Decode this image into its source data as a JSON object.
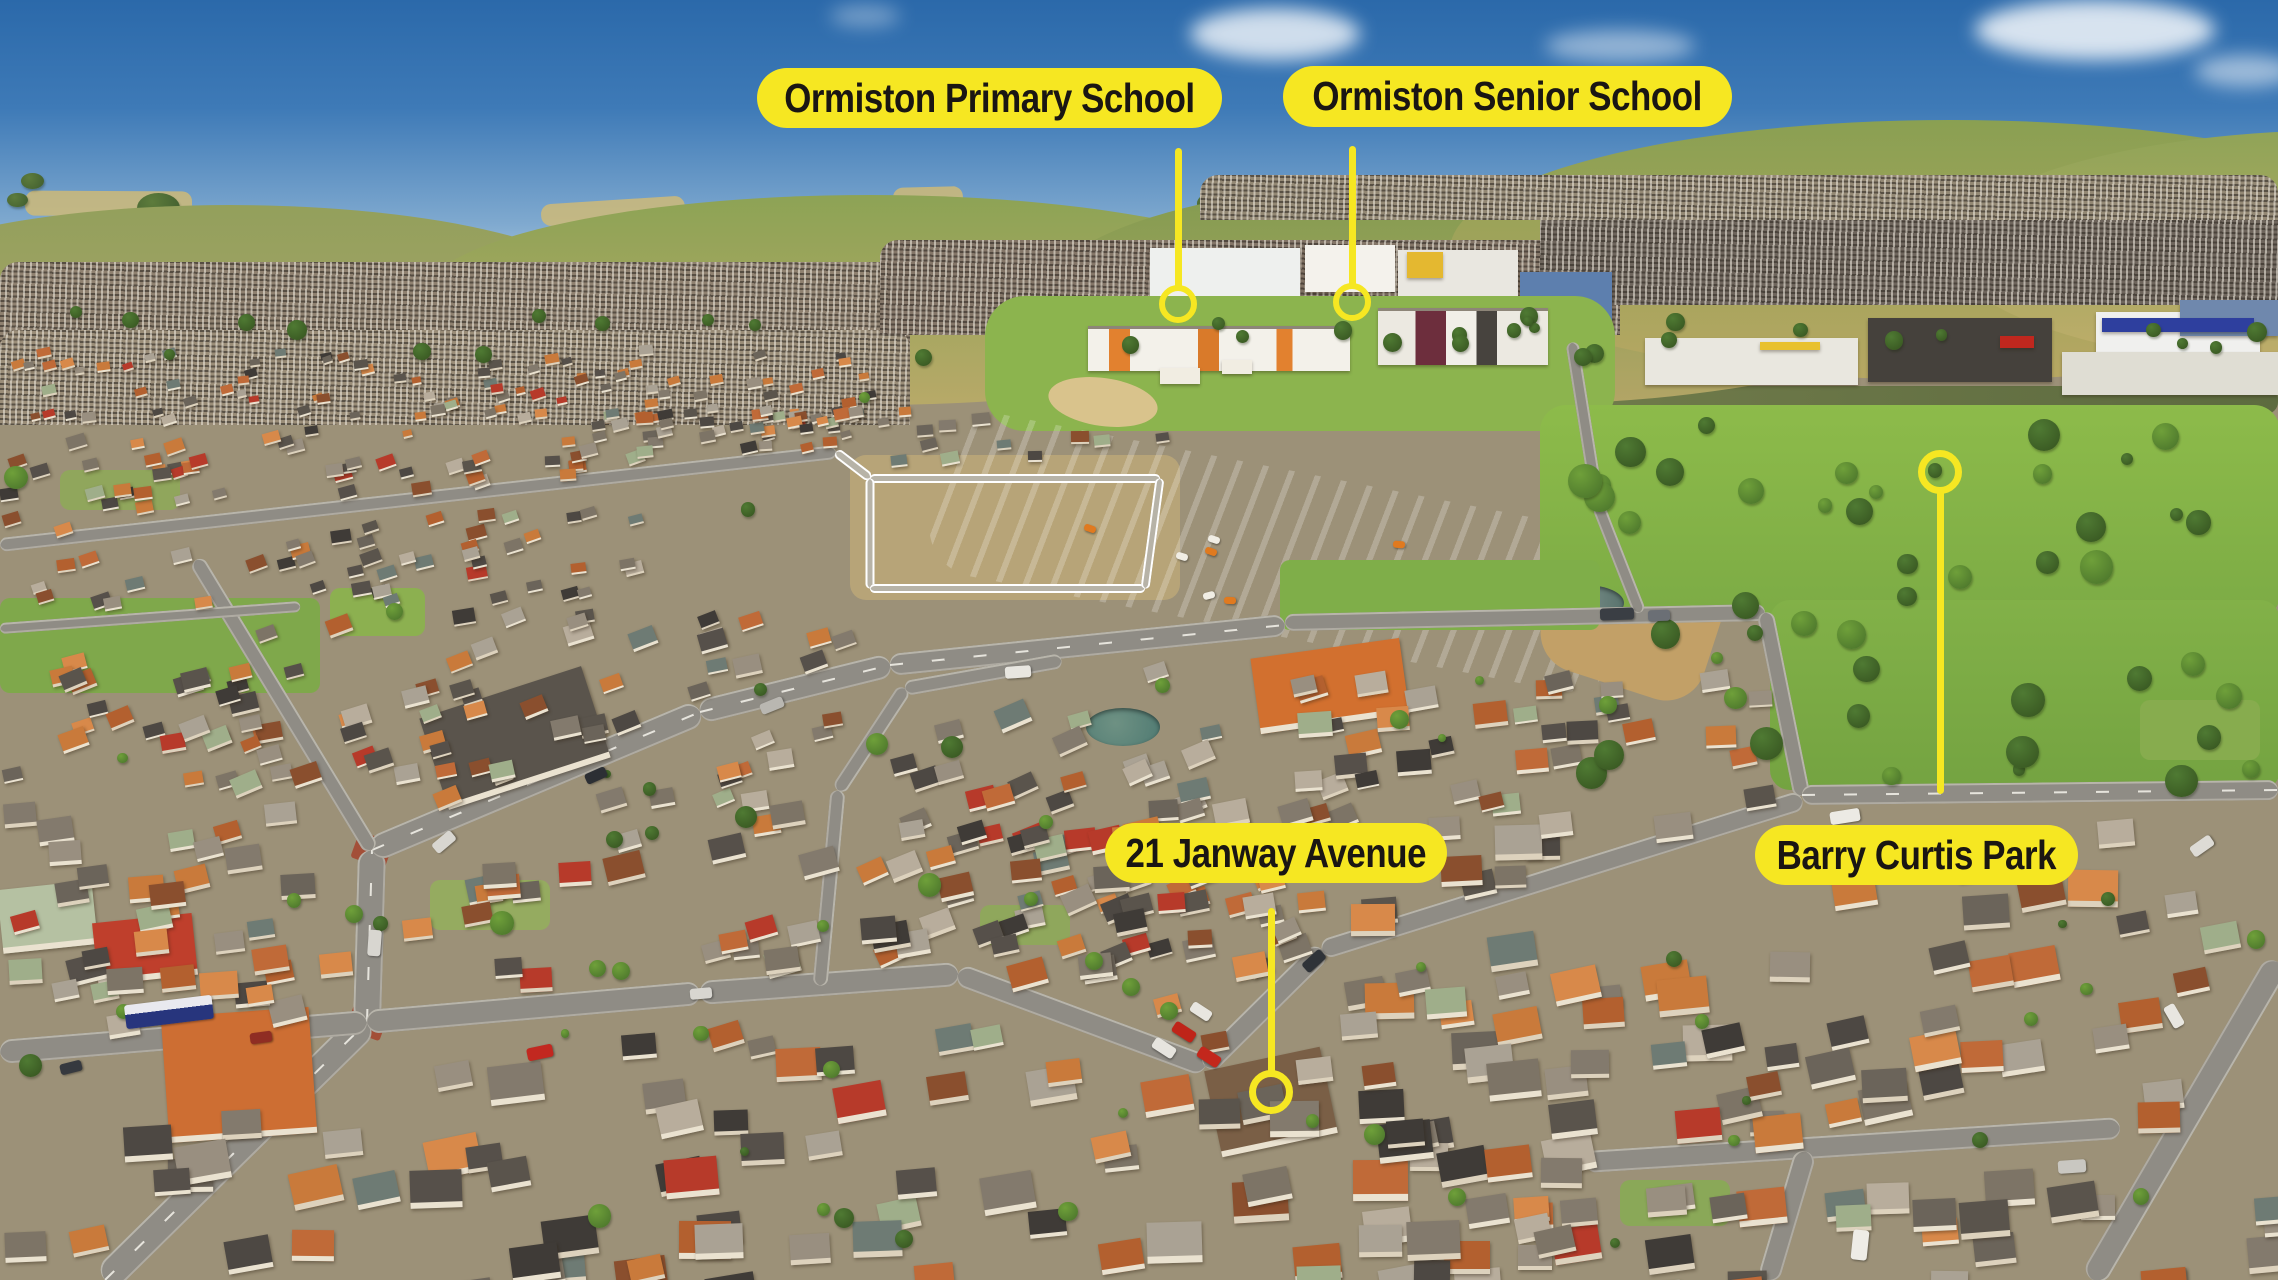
{
  "image_type": "aerial-photo-with-callouts",
  "colors": {
    "callout_fill": "#F6E722",
    "callout_text": "#1A1613"
  },
  "annotations": {
    "items": [
      {
        "id": "ormiston-primary-school",
        "label": "Ormiston Primary School",
        "pill": {
          "x": 757,
          "y": 68,
          "w": 465,
          "h": 60
        },
        "line": {
          "x": 1178,
          "y1": 148,
          "y2": 291
        },
        "ring": {
          "cx": 1178,
          "cy": 304,
          "r": 13,
          "stroke": 6
        }
      },
      {
        "id": "ormiston-senior-school",
        "label": "Ormiston Senior School",
        "pill": {
          "x": 1283,
          "y": 66,
          "w": 449,
          "h": 61
        },
        "line": {
          "x": 1352,
          "y1": 146,
          "y2": 289
        },
        "ring": {
          "cx": 1352,
          "cy": 302,
          "r": 13,
          "stroke": 6
        }
      },
      {
        "id": "21-janway-avenue",
        "label": "21 Janway Avenue",
        "pill": {
          "x": 1105,
          "y": 823,
          "w": 342,
          "h": 60
        },
        "line": {
          "x": 1271,
          "y1": 908,
          "y2": 1076
        },
        "ring": {
          "cx": 1271,
          "cy": 1092,
          "r": 15,
          "stroke": 7
        }
      },
      {
        "id": "barry-curtis-park",
        "label": "Barry Curtis Park",
        "pill": {
          "x": 1755,
          "y": 825,
          "w": 323,
          "h": 60
        },
        "line": {
          "x": 1940,
          "y1": 490,
          "y2": 794
        },
        "ring": {
          "cx": 1940,
          "cy": 472,
          "r": 15,
          "stroke": 7
        }
      }
    ]
  }
}
